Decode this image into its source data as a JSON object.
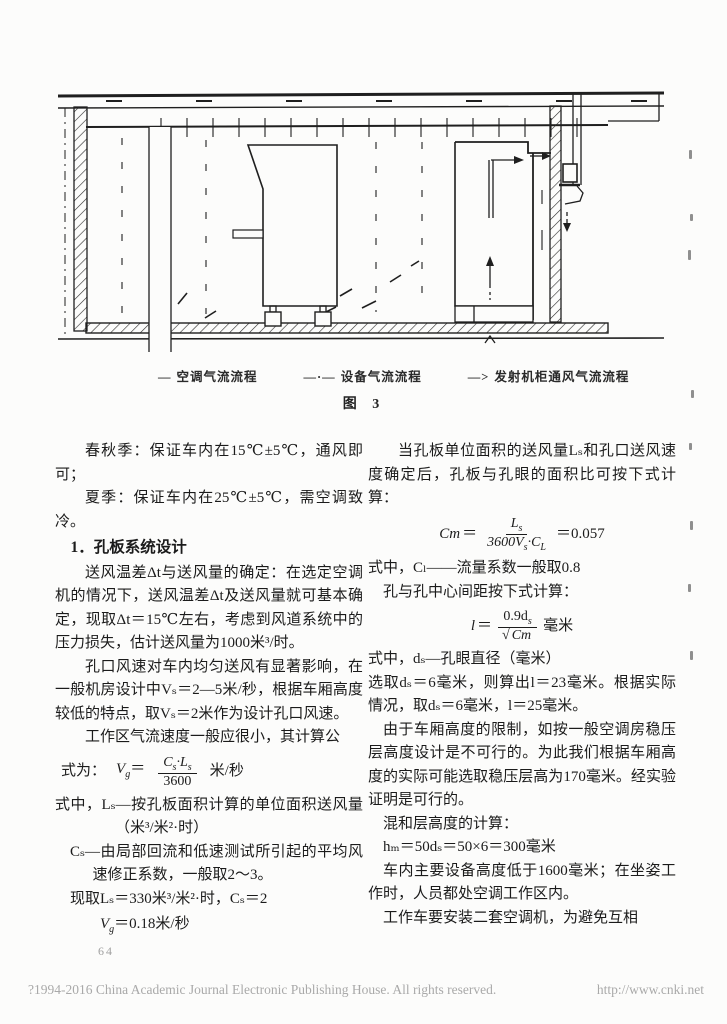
{
  "figure": {
    "legend": [
      {
        "marker": "—",
        "label": "空调气流流程"
      },
      {
        "marker": "—·—",
        "label": "设备气流流程"
      },
      {
        "marker": "—>",
        "label": "发射机柜通风气流流程"
      }
    ],
    "caption": "图 3"
  },
  "left_column": {
    "p1": "春秋季：保证车内在15℃±5℃，通风即可；",
    "p2": "夏季：保证车内在25℃±5℃，需空调致冷。",
    "h1": "1．孔板系统设计",
    "p3": "送风温差Δt与送风量的确定：在选定空调机的情况下，送风温差Δt及送风量就可基本确定，现取Δt＝15℃左右，考虑到风道系统中的压力损失，估计送风量为1000米³/时。",
    "p4": "孔口风速对车内均匀送风有显著影响，在一般机房设计中Vₛ＝2—5米/秒，根据车厢高度较低的特点，取Vₛ＝2米作为设计孔口风速。",
    "p5": "工作区气流速度一般应很小，其计算公",
    "vg_formula": {
      "lead": "式为：",
      "lhs": "V",
      "lhs_sub": "g",
      "eq": "＝",
      "num1": "C",
      "num1_sub": "s",
      "num2": "·L",
      "num2_sub": "s",
      "den": "3600",
      "unit": "米/秒"
    },
    "p6": "式中，Lₛ—按孔板面积计算的单位面积送风量（米³/米²·时）",
    "p7": "Cₛ—由局部回流和低速测试所引起的平均风速修正系数，一般取2～3。",
    "p8": "现取Lₛ＝330米³/米²·时，Cₛ＝2",
    "vg_result": {
      "lhs": "V",
      "lhs_sub": "g",
      "rest": "＝0.18米/秒"
    }
  },
  "right_column": {
    "p1": "当孔板单位面积的送风量Lₛ和孔口送风速度确定后，孔板与孔眼的面积比可按下式计算：",
    "cm_formula": {
      "lhs": "Cm",
      "eq": "＝",
      "num": "L",
      "num_sub": "s",
      "den1": "3600V",
      "den1_sub": "s",
      "den2": "·C",
      "den2_sub": "L",
      "result": "＝0.057"
    },
    "p2": "式中，Cₗ——流量系数一般取0.8",
    "p3": "孔与孔中心间距按下式计算：",
    "l_formula": {
      "lhs": "l",
      "eq": "＝",
      "num": "0.9d",
      "num_sub": "s",
      "root": "√",
      "root_arg": "Cm",
      "unit": "毫米"
    },
    "p4": "式中，dₛ—孔眼直径（毫米）",
    "p5": "选取dₛ＝6毫米，则算出l＝23毫米。根据实际情况，取dₛ＝6毫米，l＝25毫米。",
    "p6": "由于车厢高度的限制，如按一般空调房稳压层高度设计是不可行的。为此我们根据车厢高度的实际可能选取稳压层高为170毫米。经实验证明是可行的。",
    "p7": "混和层高度的计算：",
    "p8": "hₘ＝50dₛ＝50×6＝300毫米",
    "p9": "车内主要设备高度低于1600毫米；在坐姿工作时，人员都处空调工作区内。",
    "p10": "工作车要安装二套空调机，为避免互相"
  },
  "footer": {
    "page_number": "64",
    "copyright": "?1994-2016 China Academic Journal Electronic Publishing House. All rights reserved.",
    "url": "http://www.cnki.net"
  }
}
